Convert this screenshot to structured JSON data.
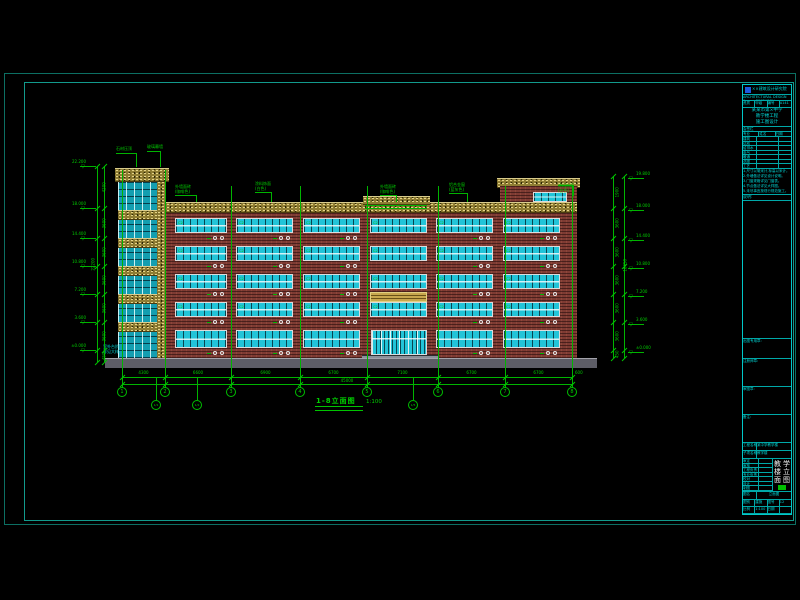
{
  "canvas": {
    "width": 800,
    "height": 600,
    "background": "#000000"
  },
  "palette": {
    "frame": "#0c6f63",
    "green": "#00b400",
    "cyan": "#00d8d8",
    "white": "#e8e8e8",
    "brick": "#7e3b33",
    "stone_yellow": "#8f7d33",
    "glass": "#22c4d8",
    "ground_gray": "#5d5d66",
    "logo_blue": "#1e5adc",
    "stamp_green": "#00c000"
  },
  "drawing": {
    "title": "1-8立面图",
    "scale": "1:100",
    "grid_bubbles": [
      "1",
      "2",
      "3",
      "4",
      "5",
      "6",
      "7",
      "8"
    ],
    "sub_grid_bubbles": [
      "1/1",
      "1/2",
      "1/5"
    ],
    "dims_row1": [
      "4300",
      "6600",
      "6900",
      "6700",
      "7100",
      "6700",
      "6700"
    ],
    "dims_total": "45000",
    "dim_extra": "600",
    "left_levels": [
      "22.200",
      "18.000",
      "14.400",
      "10.800",
      "7.200",
      "3.600",
      "±0.000"
    ],
    "right_levels": [
      "19.800",
      "18.000",
      "14.400",
      "10.800",
      "7.200",
      "3.600",
      "±0.000"
    ],
    "left_dims": [
      "4200",
      "3600",
      "3600",
      "3600",
      "3600",
      "3600",
      "450"
    ],
    "left_total": "22200",
    "right_dims": [
      "1900",
      "3600",
      "3600",
      "3600",
      "3600",
      "3600",
      "450"
    ],
    "right_total": "18450",
    "window_tag": "C2",
    "ground_label_lines": [
      "室外台阶",
      "详见大样"
    ],
    "annotations": [
      {
        "lines": [
          "石材压顶"
        ]
      },
      {
        "lines": [
          "玻璃幕墙"
        ]
      },
      {
        "lines": [
          "外墙面砖",
          "(咖啡色)"
        ]
      },
      {
        "lines": [
          "涂料饰面",
          "(白色)"
        ]
      },
      {
        "lines": [
          "外墙面砖",
          "(咖啡色)"
        ]
      },
      {
        "lines": [
          "铝合金窗",
          "(蓝灰色)"
        ]
      },
      {
        "lines": [
          "涂料饰面",
          "(白色)"
        ]
      }
    ]
  },
  "title_block": {
    "company": "××建筑设计研究院",
    "company_sub": "ARCHITECTURAL DESIGN &amp; RESEARCH INSTITUTE",
    "cert_cells": [
      "资质",
      "甲级",
      "编号",
      "A141"
    ],
    "project_lines": [
      "某某市第×中学",
      "教学楼工程",
      "施工图设计"
    ],
    "sign_label": "会签栏",
    "sign_header": [
      "专业",
      "姓名",
      "日期"
    ],
    "sign_rows": [
      "建筑",
      "结构",
      "给排水",
      "电气",
      "暖通",
      "总图",
      "工艺"
    ],
    "notes_label": "说明:",
    "notes": [
      "1.尺寸以毫米计,标高以米计。",
      "2.外墙做法详见设计说明。",
      "3.门窗规格详见门窗表。",
      "4.节点做法详见大样图。",
      "5.未尽事宜按现行规范施工。"
    ],
    "stamp_labels": [
      "出图专用章:",
      "注册师章:",
      "审图章:",
      "备注:"
    ],
    "rows_top": [
      [
        "工程名称",
        "某中学教学楼"
      ],
      [
        "子项名称",
        "教学楼"
      ]
    ],
    "item_rows": [
      "审定",
      "审核",
      "工程负责",
      "专业负责",
      "校对",
      "设计",
      "制图"
    ],
    "big_chars": [
      "教",
      "学",
      "楼",
      "立",
      "面",
      "图"
    ],
    "drawing_name_row": [
      "图名",
      "立面图"
    ],
    "bottom_cells": [
      [
        "图别",
        "建施",
        "图号",
        "12"
      ],
      [
        "比例",
        "1:100",
        "日期",
        ""
      ]
    ]
  }
}
